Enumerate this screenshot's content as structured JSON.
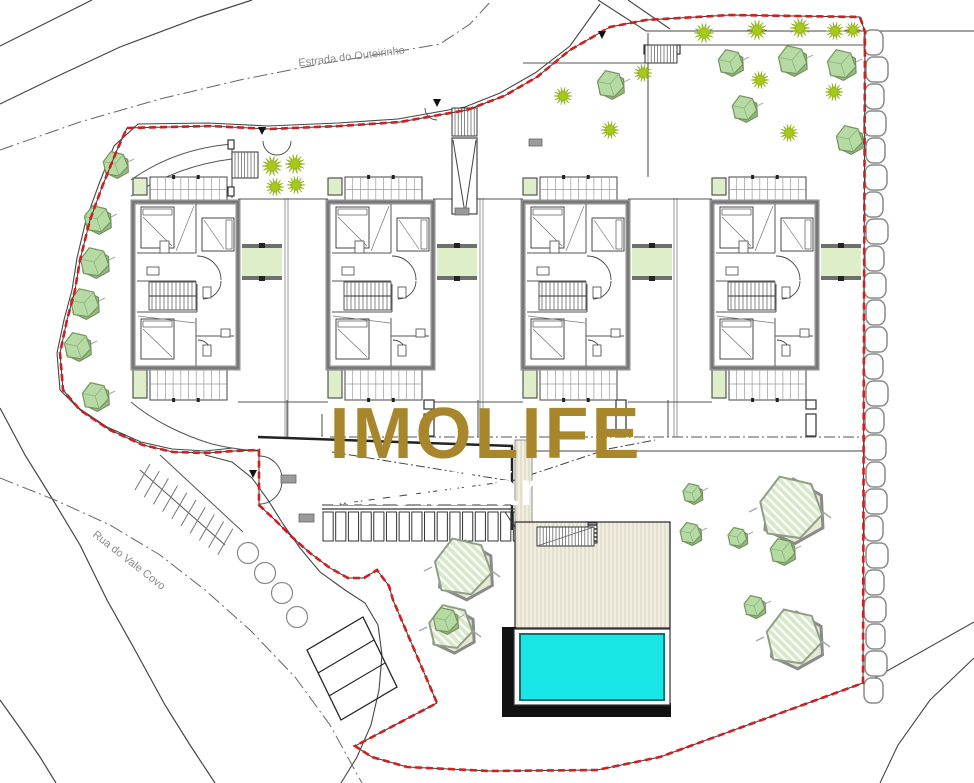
{
  "watermark": {
    "line1": "IMOLIFE",
    "line2": "Imobiliária",
    "color1": "#a8872c",
    "color2": "#ffffff",
    "x": 486,
    "y1": 458,
    "y2": 505,
    "size1": 72,
    "size2": 46
  },
  "road_labels": {
    "estrada": {
      "text": "Estrada do Outeirinho",
      "x": 352,
      "y": 60,
      "angle": -7,
      "size": 11
    },
    "rua": {
      "text": "Rua do Vale Covo",
      "x": 127,
      "y": 563,
      "angle": 38,
      "size": 11
    },
    "color": "#8a8a8a"
  },
  "palette": {
    "line": "#454545",
    "line_light": "#777777",
    "wall_gray": "#8f8f8f",
    "boundary_red": "#cf1f1f",
    "boundary_under": "#3a3a3a",
    "green_fill": "#ddeec9",
    "green_bar": "#6f6f6f",
    "tree_fill": "#b6daa4",
    "tree_back": "#95ba81",
    "tree_edge": "#75945e",
    "shrub": "#a7c91c",
    "hatch_base": "#d9e8ca",
    "hatch_back": "#e8e8d2",
    "hatch_edge": "#8f9f85",
    "pool_water": "#19e6e6",
    "pool_edge": "#0b7272",
    "pool_black": "#111111",
    "deck_base": "#f1eee1",
    "deck_stripe": "#dcd6c2",
    "stone_edge": "#8a8a8a",
    "chip": "#9a9a9a"
  },
  "boundary_points": [
    [
      127,
      128
    ],
    [
      210,
      126
    ],
    [
      270,
      129
    ],
    [
      340,
      126
    ],
    [
      400,
      122
    ],
    [
      467,
      110
    ],
    [
      504,
      96
    ],
    [
      537,
      77
    ],
    [
      570,
      50
    ],
    [
      610,
      27
    ],
    [
      646,
      20
    ],
    [
      730,
      15
    ],
    [
      860,
      17
    ],
    [
      865,
      32
    ],
    [
      864,
      300
    ],
    [
      863,
      683
    ],
    [
      660,
      757
    ],
    [
      597,
      770
    ],
    [
      490,
      771
    ],
    [
      407,
      767
    ],
    [
      372,
      757
    ],
    [
      355,
      746
    ],
    [
      437,
      703
    ],
    [
      393,
      600
    ],
    [
      389,
      586
    ],
    [
      377,
      570
    ],
    [
      364,
      578
    ],
    [
      348,
      578
    ],
    [
      330,
      568
    ],
    [
      310,
      553
    ],
    [
      292,
      537
    ],
    [
      275,
      520
    ],
    [
      259,
      505
    ],
    [
      259,
      450
    ],
    [
      233,
      451
    ],
    [
      207,
      453
    ],
    [
      173,
      452
    ],
    [
      143,
      445
    ],
    [
      110,
      430
    ],
    [
      80,
      410
    ],
    [
      63,
      390
    ],
    [
      60,
      353
    ],
    [
      67,
      320
    ],
    [
      75,
      290
    ],
    [
      80,
      260
    ],
    [
      90,
      220
    ],
    [
      102,
      187
    ],
    [
      117,
      150
    ],
    [
      127,
      128
    ]
  ],
  "roads": {
    "nw_edge": [
      [
        600,
        4
      ],
      [
        570,
        46
      ],
      [
        535,
        73
      ],
      [
        500,
        93
      ],
      [
        465,
        107
      ],
      [
        398,
        119
      ],
      [
        338,
        123
      ],
      [
        268,
        126
      ],
      [
        208,
        123
      ],
      [
        138,
        124
      ],
      [
        114,
        146
      ],
      [
        99,
        184
      ],
      [
        86,
        220
      ],
      [
        77,
        258
      ],
      [
        72,
        290
      ],
      [
        64,
        320
      ],
      [
        57,
        353
      ],
      [
        60,
        390
      ],
      [
        77,
        407
      ],
      [
        107,
        427
      ],
      [
        141,
        442
      ],
      [
        172,
        449
      ],
      [
        205,
        451
      ],
      [
        233,
        448
      ]
    ],
    "drive_edge": [
      [
        205,
        455
      ],
      [
        232,
        462
      ],
      [
        252,
        478
      ],
      [
        268,
        500
      ],
      [
        283,
        524
      ],
      [
        300,
        548
      ],
      [
        320,
        572
      ],
      [
        345,
        590
      ],
      [
        365,
        603
      ],
      [
        378,
        625
      ],
      [
        382,
        655
      ],
      [
        379,
        690
      ],
      [
        371,
        725
      ],
      [
        357,
        757
      ],
      [
        341,
        783
      ]
    ],
    "left_outer": [
      [
        0,
        408
      ],
      [
        25,
        455
      ],
      [
        53,
        500
      ],
      [
        80,
        545
      ],
      [
        107,
        600
      ],
      [
        135,
        650
      ],
      [
        165,
        705
      ],
      [
        190,
        745
      ],
      [
        215,
        783
      ]
    ],
    "left_corner": [
      [
        0,
        700
      ],
      [
        20,
        728
      ],
      [
        40,
        757
      ],
      [
        56,
        783
      ]
    ],
    "rua_center": [
      [
        0,
        478
      ],
      [
        55,
        500
      ],
      [
        110,
        525
      ],
      [
        160,
        555
      ],
      [
        205,
        590
      ],
      [
        250,
        630
      ],
      [
        295,
        677
      ],
      [
        330,
        725
      ],
      [
        362,
        783
      ]
    ],
    "estrada_center": [
      [
        0,
        150
      ],
      [
        80,
        122
      ],
      [
        160,
        99
      ],
      [
        240,
        80
      ],
      [
        320,
        64
      ],
      [
        400,
        51
      ],
      [
        440,
        44
      ],
      [
        470,
        24
      ],
      [
        492,
        0
      ]
    ],
    "top1": [
      [
        92,
        0
      ],
      [
        60,
        16
      ],
      [
        28,
        32
      ],
      [
        0,
        46
      ]
    ],
    "top2": [
      [
        252,
        0
      ],
      [
        200,
        17
      ],
      [
        120,
        47
      ],
      [
        60,
        75
      ],
      [
        0,
        104
      ]
    ],
    "tr_diag1": [
      [
        598,
        0
      ],
      [
        646,
        31
      ]
    ],
    "tr_diag2": [
      [
        628,
        0
      ],
      [
        670,
        29
      ]
    ],
    "tr_horiz": [
      [
        646,
        31
      ],
      [
        974,
        31
      ]
    ],
    "br_edge1": [
      [
        974,
        622
      ],
      [
        864,
        684
      ]
    ],
    "br_edge2": [
      [
        974,
        658
      ],
      [
        930,
        700
      ],
      [
        898,
        745
      ],
      [
        880,
        783
      ]
    ]
  },
  "houses": {
    "x_origins": [
      133,
      328,
      523,
      712
    ],
    "top_y": 177
  },
  "dividers": [
    [
      285,
      288
    ],
    [
      480,
      483
    ],
    [
      674,
      677
    ]
  ],
  "gap_lines_top": [
    [
      238,
      199,
      328,
      199
    ],
    [
      433,
      199,
      523,
      199
    ],
    [
      628,
      199,
      712,
      199
    ]
  ],
  "gap_lines_bottom": [
    [
      238,
      402,
      328,
      402
    ],
    [
      433,
      402,
      523,
      402
    ],
    [
      628,
      402,
      712,
      402
    ]
  ],
  "garden_walls": [
    [
      523,
      63,
      648,
      63
    ],
    [
      648,
      33,
      648,
      177
    ],
    [
      677,
      45,
      863,
      45
    ],
    [
      232,
      143,
      232,
      198
    ]
  ],
  "entry_curves": [
    "M 131,180 C 162,158 196,147 232,144",
    "M 131,196 C 165,174 199,163 232,159",
    "M 131,402 C 152,420 182,435 212,444 C 228,448 244,450 258,451"
  ],
  "stairs": [
    {
      "x": 232,
      "y": 152,
      "w": 26,
      "h": 26,
      "dir": "v"
    },
    {
      "x": 452,
      "y": 108,
      "w": 25,
      "h": 28,
      "dir": "v"
    },
    {
      "x": 645,
      "y": 45,
      "w": 32,
      "h": 18,
      "dir": "v"
    },
    {
      "x": 537,
      "y": 527,
      "w": 57,
      "h": 19,
      "dir": "v"
    }
  ],
  "v_ramp": {
    "x": 452,
    "y": 138,
    "w": 25,
    "h": 76
  },
  "gate_arcs": [
    "M 263,141 A 14,14 0 0 0 277,155",
    "M 291,141 A 14,14 0 0 1 277,155",
    "M 425,108 A 12,12 0 0 0 437,120",
    "M 259,456 A 23,23 0 0 1 282,479",
    "M 259,504 A 23,23 0 0 0 282,481"
  ],
  "markers": [
    [
      262,
      131
    ],
    [
      437,
      103
    ],
    [
      602,
      35
    ],
    [
      253,
      474
    ]
  ],
  "chips": [
    [
      281,
      475,
      15,
      8
    ],
    [
      299,
      514,
      15,
      8
    ],
    [
      455,
      208,
      14,
      7
    ],
    [
      529,
      139,
      13,
      7
    ]
  ],
  "circles": [
    [
      248,
      553
    ],
    [
      265,
      573
    ],
    [
      282,
      593
    ],
    [
      297,
      617
    ]
  ],
  "circle_r": 10.5,
  "parking_stripes": {
    "n": 10,
    "x0": 150,
    "y0": 464,
    "dx": 9.2,
    "dy": 7.2,
    "len_x": -15,
    "len_y": 26,
    "edges": [
      "M 140,470 L 225,545",
      "M 160,455 L 243,532"
    ]
  },
  "rot_parking": {
    "pts": [
      [
        307,
        650
      ],
      [
        363,
        617
      ],
      [
        397,
        687
      ],
      [
        341,
        720
      ]
    ],
    "divs": [
      [
        318,
        673,
        374,
        640
      ],
      [
        329,
        696,
        385,
        663
      ]
    ]
  },
  "ramp": {
    "top": "M 258,437 L 513,446",
    "right": "M 512,446 L 512,530",
    "bottom": "M 322,509 L 513,509",
    "dash1": "M 332,452 L 511,481",
    "dash2": "M 332,505 L 511,481",
    "dash3": "M 512,481 L 608,449 L 655,440"
  },
  "court_lines": {
    "dashdot_y437": [
      330,
      437,
      864,
      437
    ],
    "solid_y451": [
      515,
      451,
      864,
      451
    ]
  },
  "pergola": {
    "x": 322,
    "y": 512,
    "w": 203,
    "h": 29,
    "cells": 16,
    "top1": 505,
    "top2": 509
  },
  "posts": [
    [
      228,
      140,
      6,
      9
    ],
    [
      228,
      187,
      6,
      9
    ],
    [
      644,
      45,
      5,
      9
    ],
    [
      675,
      45,
      5,
      9
    ],
    [
      424,
      400,
      10,
      9
    ],
    [
      424,
      414,
      10,
      22
    ],
    [
      616,
      400,
      10,
      9
    ],
    [
      616,
      414,
      10,
      22
    ],
    [
      806,
      400,
      10,
      9
    ],
    [
      806,
      414,
      10,
      22
    ]
  ],
  "short_walls": [
    [
      287,
      400,
      287,
      437
    ],
    [
      322,
      414,
      322,
      437
    ],
    [
      478,
      400,
      478,
      437
    ],
    [
      668,
      400,
      668,
      437
    ]
  ],
  "deck": {
    "strip": [
      515,
      440,
      17,
      82
    ],
    "main": [
      515,
      522,
      155,
      106
    ],
    "hatch_box": [
      588,
      523,
      9,
      20
    ],
    "stair_diag": [
      537,
      546,
      594,
      527
    ]
  },
  "pool": {
    "black_l": [
      502,
      627,
      14,
      90
    ],
    "black_b": [
      502,
      703,
      169,
      14
    ],
    "frame": [
      514,
      629,
      156,
      76
    ],
    "water": [
      520,
      634,
      144,
      66
    ]
  },
  "stone_wall": {
    "x": 865,
    "y_top": 30,
    "y_bottom": 682,
    "block_h": 27,
    "block_w": 20
  },
  "trees_solid": [
    [
      115,
      164,
      13
    ],
    [
      97,
      219,
      14
    ],
    [
      94,
      262,
      15
    ],
    [
      84,
      303,
      15
    ],
    [
      77,
      346,
      14
    ],
    [
      95,
      396,
      14
    ],
    [
      610,
      84,
      14
    ],
    [
      730,
      62,
      13
    ],
    [
      792,
      60,
      15
    ],
    [
      841,
      64,
      15
    ],
    [
      744,
      108,
      13
    ],
    [
      849,
      139,
      14
    ],
    [
      692,
      493,
      10
    ],
    [
      690,
      533,
      11
    ],
    [
      737,
      537,
      10
    ],
    [
      754,
      606,
      11
    ],
    [
      782,
      551,
      13
    ],
    [
      445,
      620,
      13
    ]
  ],
  "trees_star": [
    [
      272,
      166,
      10
    ],
    [
      295,
      164,
      10
    ],
    [
      275,
      187,
      9
    ],
    [
      296,
      185,
      9
    ],
    [
      563,
      96,
      9
    ],
    [
      610,
      130,
      9
    ],
    [
      643,
      73,
      9
    ],
    [
      704,
      33,
      10
    ],
    [
      757,
      30,
      10
    ],
    [
      800,
      28,
      10
    ],
    [
      835,
      31,
      9
    ],
    [
      853,
      30,
      8
    ],
    [
      760,
      80,
      9
    ],
    [
      834,
      92,
      9
    ],
    [
      789,
      133,
      9
    ]
  ],
  "trees_hatched": [
    [
      462,
      567,
      30
    ],
    [
      450,
      627,
      23
    ],
    [
      790,
      508,
      33
    ],
    [
      793,
      637,
      29
    ]
  ]
}
